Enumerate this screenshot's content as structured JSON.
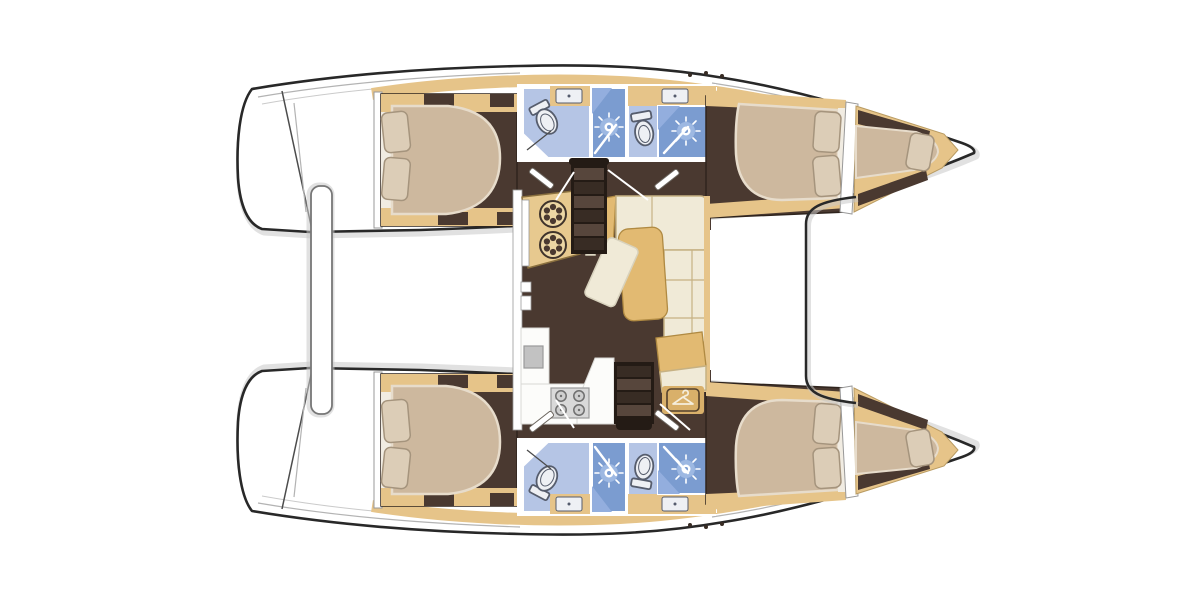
{
  "diagram": {
    "type": "boat-interior-floor-plan",
    "subject": "sailing catamaran layout, top-down view",
    "orientation": {
      "bow": "right",
      "stern": "left"
    },
    "hulls": [
      {
        "name": "port-hull",
        "rooms": [
          {
            "name": "aft-cabin",
            "features": [
              "double-berth-mattress",
              "pillow",
              "pillow",
              "side-lockers",
              "deck-hatches"
            ]
          },
          {
            "name": "bathroom-aft",
            "features": [
              "toilet",
              "washbasin",
              "shower-cubicle",
              "shower-rose"
            ]
          },
          {
            "name": "bathroom-forward",
            "features": [
              "toilet",
              "washbasin",
              "shower-cubicle",
              "shower-rose"
            ]
          },
          {
            "name": "forward-cabin",
            "features": [
              "double-berth-mattress",
              "pillow",
              "pillow"
            ]
          },
          {
            "name": "forepeak-berth",
            "features": [
              "single-berth-mattress",
              "pillow",
              "storage-shelves"
            ]
          },
          {
            "name": "companionway",
            "features": [
              "stairs",
              "cabin-doors"
            ]
          }
        ]
      },
      {
        "name": "starboard-hull",
        "rooms": [
          {
            "name": "aft-cabin",
            "features": [
              "double-berth-mattress",
              "pillow",
              "pillow",
              "side-lockers",
              "deck-hatches"
            ]
          },
          {
            "name": "bathroom-aft",
            "features": [
              "toilet",
              "washbasin",
              "shower-cubicle",
              "shower-rose"
            ]
          },
          {
            "name": "bathroom-forward",
            "features": [
              "toilet",
              "washbasin",
              "shower-cubicle",
              "shower-rose"
            ]
          },
          {
            "name": "forward-cabin",
            "features": [
              "double-berth-mattress",
              "pillow",
              "pillow"
            ]
          },
          {
            "name": "forepeak-berth",
            "features": [
              "single-berth-mattress",
              "pillow",
              "storage-shelves"
            ]
          },
          {
            "name": "companionway",
            "features": [
              "stairs",
              "cabin-doors"
            ]
          }
        ]
      }
    ],
    "saloon": {
      "name": "bridgedeck-saloon",
      "features": [
        "nav-console-with-two-winches",
        "l-shaped-sofa",
        "dining-table",
        "ottoman",
        "galley-counter",
        "sink",
        "four-burner-stove",
        "wardrobe-with-hanger-icon",
        "port-companionway-stairs",
        "starboard-companionway-stairs"
      ]
    },
    "exterior": {
      "features": [
        "twin-stern-transom-steps",
        "central-stern-platform",
        "forward-cockpit-recess",
        "bow-points"
      ]
    }
  },
  "colors": {
    "hull_fill": "#ffffff",
    "hull_outline": "#282828",
    "shadow_gray": "#c9c9c9",
    "seam_gray": "#b3b3b3",
    "wood_trim": "#e6c489",
    "wood_edge": "#b99b62",
    "floor_dark": "#4a3930",
    "floor_edge": "#2f241d",
    "sheet_white": "#f1ece2",
    "mattress": "#cdb89e",
    "mattress_edge": "#e7dccb",
    "pillow": "#dccdb7",
    "pillow_edge": "#a5947d",
    "wall_gray": "#999999",
    "bath_light": "#b5c5e5",
    "bath_shower": "#7b9cd0",
    "bath_shower_hi": "#93aede",
    "fixture_white": "#eef0f4",
    "fixture_edge": "#565d6d",
    "sofa_cream": "#f0ead7",
    "sofa_edge": "#c6b183",
    "table_tan": "#e2ba72",
    "table_edge": "#b08a42",
    "galley_white": "#fcfcfa",
    "galley_edge": "#d8d8d4",
    "stove_gray": "#d9d9d9",
    "stove_edge": "#9a9a9a",
    "burner_gray": "#cfcfcf",
    "burner_edge": "#6f6f6f",
    "stairs_frame": "#241b15",
    "stairs_light": "#57463c",
    "stairs_dark": "#382c24",
    "door_edge": "#6b655e",
    "console_tan": "#e7c98f",
    "console_edge": "#8a703f",
    "winch_face": "#ecd6a4",
    "winch_edge": "#3f332b",
    "wardrobe_tan": "#d9b06a",
    "icon_dark": "#53402c",
    "hanger_cream": "#f5eedd"
  }
}
